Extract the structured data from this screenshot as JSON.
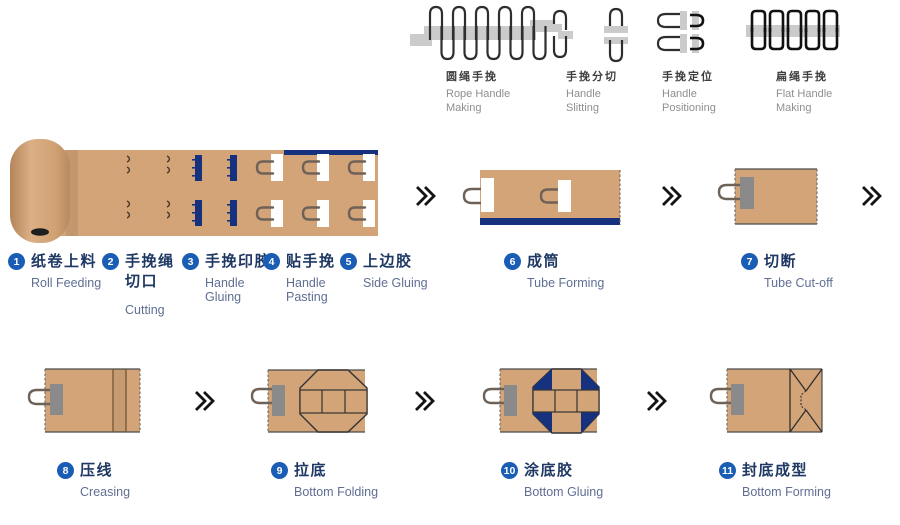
{
  "colors": {
    "kraft": "#D2A478",
    "navy": "#16317D",
    "circle": "#1A5DB4",
    "zh": "#1F3864",
    "en": "#5F6F93",
    "topzh": "#3F3F3F",
    "topen": "#8F8F8F",
    "graybar": "#CBCBCB",
    "patch": "#8A8A8A",
    "arrow": "#141414"
  },
  "top_processes": [
    {
      "zh": "圆绳手挽",
      "en": "Rope Handle\nMaking",
      "icon": "rope-handle-making-icon"
    },
    {
      "zh": "手挽分切",
      "en": "Handle\nSlitting",
      "icon": "handle-slitting-icon"
    },
    {
      "zh": "手挽定位",
      "en": "Handle\nPositioning",
      "icon": "handle-positioning-icon"
    },
    {
      "zh": "扁绳手挽",
      "en": "Flat Handle\nMaking",
      "icon": "flat-handle-making-icon"
    }
  ],
  "steps": [
    {
      "num": "1",
      "zh": "纸卷上料",
      "en": "Roll Feeding"
    },
    {
      "num": "2",
      "zh": "手挽绳\n切口",
      "en": "Cutting"
    },
    {
      "num": "3",
      "zh": "手挽印胶",
      "en": "Handle\nGluing"
    },
    {
      "num": "4",
      "zh": "贴手挽",
      "en": "Handle\nPasting"
    },
    {
      "num": "5",
      "zh": "上边胶",
      "en": "Side Gluing"
    },
    {
      "num": "6",
      "zh": "成筒",
      "en": "Tube Forming"
    },
    {
      "num": "7",
      "zh": "切断",
      "en": "Tube Cut-off"
    },
    {
      "num": "8",
      "zh": "压线",
      "en": "Creasing"
    },
    {
      "num": "9",
      "zh": "拉底",
      "en": "Bottom Folding"
    },
    {
      "num": "10",
      "zh": "涂底胶",
      "en": "Bottom Gluing"
    },
    {
      "num": "11",
      "zh": "封底成型",
      "en": "Bottom Forming"
    }
  ]
}
